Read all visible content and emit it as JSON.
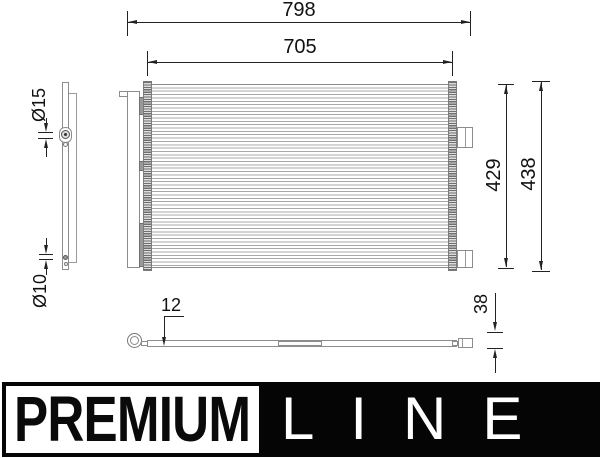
{
  "drawing": {
    "type": "technical-drawing-condenser",
    "dimensions": {
      "overall_width": "798",
      "core_width": "705",
      "core_height": "429",
      "overall_height": "438",
      "top_port_diameter": "Ø15",
      "bottom_port_diameter": "Ø10",
      "core_depth": "12",
      "overall_depth": "38"
    },
    "logo": {
      "premium_label": "PREMIUM",
      "line_label": "LINE"
    },
    "colors": {
      "dimension_ink": "#222222",
      "part_outline": "#8c8c8c",
      "core_stripe": "#a9a9a9",
      "logo_black": "#050505",
      "logo_white": "#ffffff"
    }
  }
}
